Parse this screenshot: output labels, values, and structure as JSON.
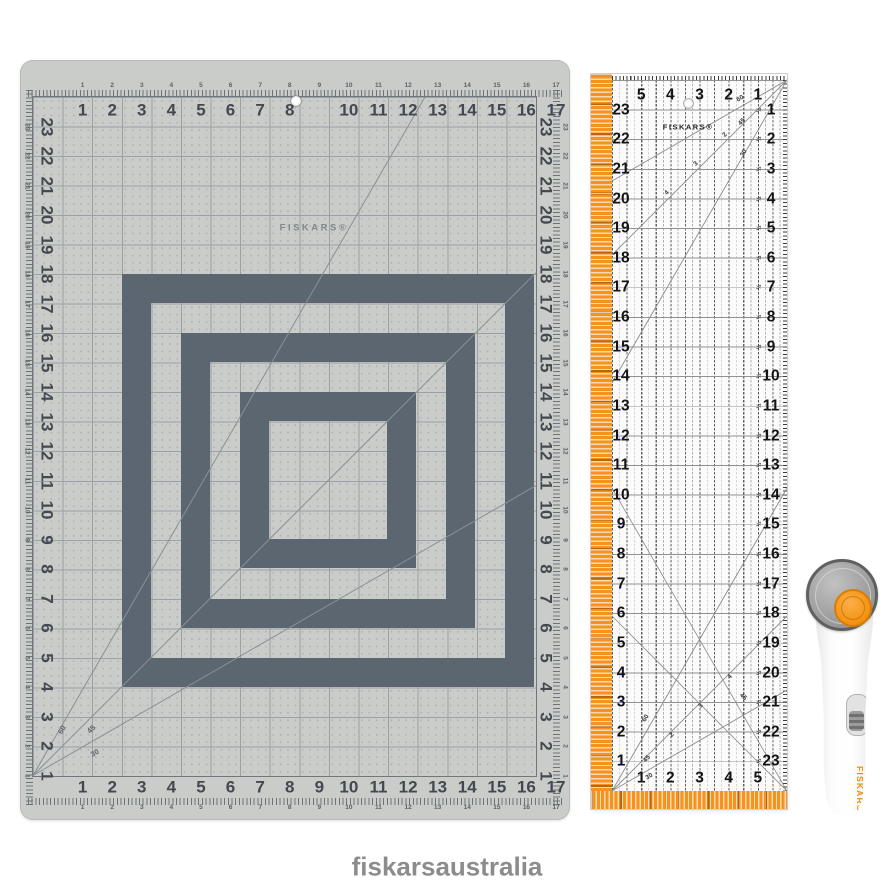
{
  "page": {
    "brand_text": "fiskarsaustralia"
  },
  "colors": {
    "accent_orange": "#f6921e",
    "mat_body": "#c9ccc9",
    "mat_dark_cell": "#5c6671",
    "ruler_body": "#fbfbfb",
    "logo_gray": "#8c8c8c"
  },
  "mat": {
    "brand": "FISKARS®",
    "top_numbers": [
      "1",
      "2",
      "3",
      "4",
      "5",
      "6",
      "7",
      "8",
      "",
      "10",
      "11",
      "12",
      "13",
      "14",
      "15",
      "16",
      "17"
    ],
    "bottom_numbers": [
      "1",
      "2",
      "3",
      "4",
      "5",
      "6",
      "7",
      "8",
      "9",
      "10",
      "11",
      "12",
      "13",
      "14",
      "15",
      "16",
      "17"
    ],
    "left_numbers": [
      "23",
      "22",
      "21",
      "20",
      "19",
      "18",
      "17",
      "16",
      "15",
      "14",
      "13",
      "12",
      "11",
      "10",
      "9",
      "8",
      "7",
      "6",
      "5",
      "4",
      "3",
      "2",
      "1"
    ],
    "right_numbers": [
      "23",
      "22",
      "21",
      "20",
      "19",
      "18",
      "17",
      "16",
      "15",
      "14",
      "13",
      "12",
      "11",
      "10",
      "9",
      "8",
      "7",
      "6",
      "5",
      "4",
      "3",
      "2",
      "1"
    ],
    "angle_labels": [
      "60",
      "45",
      "30"
    ]
  },
  "ruler": {
    "brand": "FISKARS®",
    "top_numbers": [
      "5",
      "4",
      "3",
      "2",
      "1"
    ],
    "bottom_numbers": [
      "1",
      "2",
      "3",
      "4",
      "5"
    ],
    "left_numbers": [
      "23",
      "22",
      "21",
      "20",
      "19",
      "18",
      "17",
      "16",
      "15",
      "14",
      "13",
      "12",
      "11",
      "10",
      "9",
      "8",
      "7",
      "6",
      "5",
      "4",
      "3",
      "2",
      "1"
    ],
    "right_numbers": [
      "1",
      "2",
      "3",
      "4",
      "5",
      "6",
      "7",
      "8",
      "9",
      "10",
      "11",
      "12",
      "13",
      "14",
      "15",
      "16",
      "17",
      "18",
      "19",
      "20",
      "21",
      "22",
      "23"
    ],
    "half_mark": "½",
    "angle_labels_top": [
      "60",
      "45",
      "30"
    ],
    "angle_labels_bottom": [
      "60",
      "45",
      "30"
    ],
    "angle_label_br": "45",
    "diagonal_markers": [
      "2",
      "3",
      "4"
    ]
  },
  "cutter": {
    "brand": "FISKARS®"
  }
}
